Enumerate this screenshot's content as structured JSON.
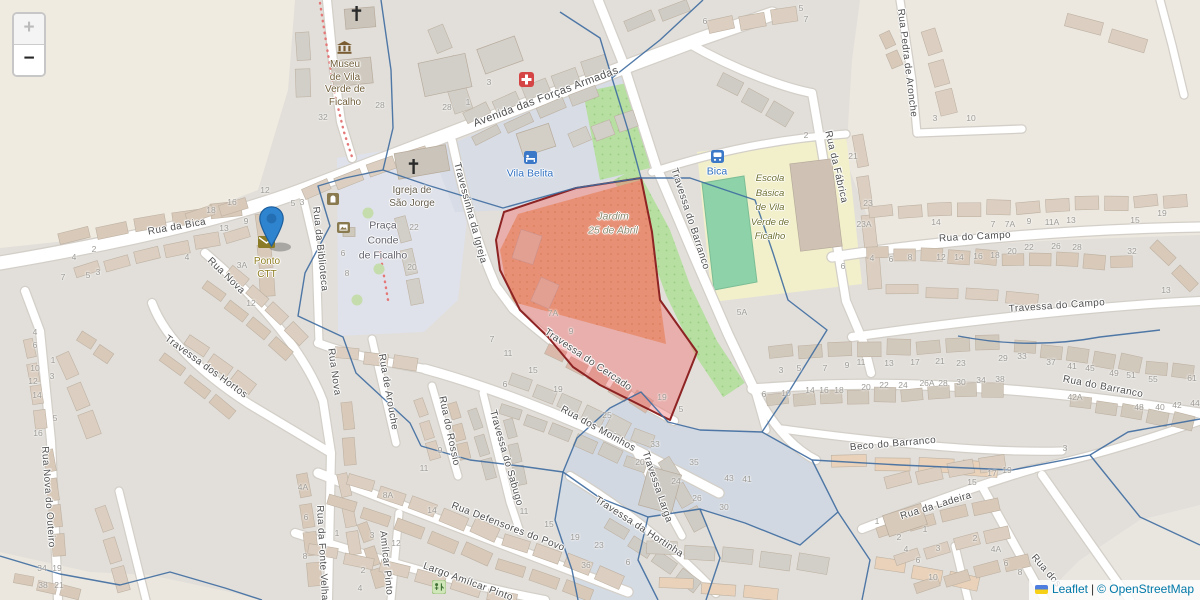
{
  "map": {
    "controls": {
      "zoom_in_label": "+",
      "zoom_out_label": "−"
    },
    "attribution": {
      "flag_icon": "ukraine-flag",
      "leaflet_link": "Leaflet",
      "separator": "|",
      "osm_link": "© OpenStreetMap"
    },
    "selected_area": {
      "name": "Jardim 25 de Abril area",
      "fill_color": "rgba(240,110,110,0.42)",
      "border_color": "#8d2323"
    },
    "marker": {
      "color": "#2e84cf"
    },
    "streets": [
      {
        "label": "Avenida das Forças Armadas",
        "x": 546,
        "y": 97,
        "rot": -20.5,
        "size": 11
      },
      {
        "label": "Rua da Bica",
        "x": 177,
        "y": 227,
        "rot": -10
      },
      {
        "label": "Rua Nova",
        "x": 226,
        "y": 276,
        "rot": 44
      },
      {
        "label": "Rua Nova",
        "x": 334,
        "y": 372,
        "rot": 82
      },
      {
        "label": "Rua Nova do Outeiro",
        "x": 48,
        "y": 497,
        "rot": 86
      },
      {
        "label": "Travessa dos Hortos",
        "x": 206,
        "y": 367,
        "rot": 36
      },
      {
        "label": "Rua da Biblioteca",
        "x": 320,
        "y": 249,
        "rot": 84
      },
      {
        "label": "Rua da Fonte Velha",
        "x": 322,
        "y": 553,
        "rot": 87
      },
      {
        "label": "Amílcar Pinto",
        "x": 386,
        "y": 563,
        "rot": 84
      },
      {
        "label": "Rua de Arouche",
        "x": 388,
        "y": 392,
        "rot": 80
      },
      {
        "label": "Rua do Rossio",
        "x": 449,
        "y": 431,
        "rot": 78
      },
      {
        "label": "Travessa do Sabugo",
        "x": 506,
        "y": 458,
        "rot": 74
      },
      {
        "label": "Rua dos Moinhos",
        "x": 598,
        "y": 429,
        "rot": 29
      },
      {
        "label": "Travessa Larga",
        "x": 657,
        "y": 487,
        "rot": 71
      },
      {
        "label": "Travessa da Hortinha",
        "x": 639,
        "y": 527,
        "rot": 33
      },
      {
        "label": "Rua Defensores do Povo",
        "x": 508,
        "y": 527,
        "rot": 21
      },
      {
        "label": "Largo Amílcar Pinto",
        "x": 468,
        "y": 582,
        "rot": 20
      },
      {
        "label": "Travessinha da Igreja",
        "x": 470,
        "y": 213,
        "rot": 75
      },
      {
        "label": "Travessa do Cercado",
        "x": 588,
        "y": 360,
        "rot": 34
      },
      {
        "label": "Travessa do Barranco",
        "x": 690,
        "y": 219,
        "rot": 72
      },
      {
        "label": "Rua da Fábrica",
        "x": 836,
        "y": 167,
        "rot": 77
      },
      {
        "label": "Rua Pedra de Aronche",
        "x": 907,
        "y": 63,
        "rot": 83
      },
      {
        "label": "Rua do Campo",
        "x": 975,
        "y": 237,
        "rot": -3
      },
      {
        "label": "Travessa do Campo",
        "x": 1057,
        "y": 306,
        "rot": -4
      },
      {
        "label": "Rua do Barranco",
        "x": 1103,
        "y": 387,
        "rot": 11
      },
      {
        "label": "Beco do Barranco",
        "x": 893,
        "y": 444,
        "rot": -5
      },
      {
        "label": "Rua da Ladeira",
        "x": 936,
        "y": 506,
        "rot": -17
      },
      {
        "label": "Rua dos",
        "x": 1046,
        "y": 571,
        "rot": 49
      }
    ],
    "pois": [
      {
        "name": "museum-label",
        "label": "Museu\nde Vila\nVerde de\nFicalho",
        "x": 345,
        "y": 84,
        "color": "#6f5d39",
        "size": 10,
        "lh": 12.5,
        "italic": false
      },
      {
        "name": "church-label",
        "label": "Igreja de\nSão Jorge",
        "x": 412,
        "y": 197,
        "color": "#655d4e",
        "size": 10,
        "lh": 13,
        "italic": false
      },
      {
        "name": "hotel-label",
        "label": "Vila Belita",
        "x": 530,
        "y": 174,
        "color": "#2f6fc0",
        "size": 10.5,
        "lh": 13,
        "italic": false
      },
      {
        "name": "square-label",
        "label": "Praça\nConde\nde Ficalho",
        "x": 383,
        "y": 241,
        "color": "#60606b",
        "size": 10.5,
        "lh": 15,
        "italic": false
      },
      {
        "name": "post-office-label",
        "label": "Ponto\nCTT",
        "x": 267,
        "y": 268,
        "color": "#8d7d1f",
        "size": 10,
        "lh": 13,
        "italic": false
      },
      {
        "name": "garden-label",
        "label": "Jardim\n25 de Abril",
        "x": 613,
        "y": 224,
        "color": "#8b8b72",
        "size": 10.5,
        "lh": 13.5,
        "italic": true
      },
      {
        "name": "school-label",
        "label": "Escola\nBásica\nde Vila\nVerde de\nFicalho",
        "x": 770,
        "y": 208,
        "color": "#6f7030",
        "size": 9.5,
        "lh": 14.5,
        "italic": true
      },
      {
        "name": "bus-stop-label",
        "label": "Bica",
        "x": 717,
        "y": 172,
        "color": "#2f6fc0",
        "size": 10.5,
        "lh": 13,
        "italic": false
      }
    ],
    "icons": [
      {
        "type": "church-icon",
        "x": 350,
        "y": 6
      },
      {
        "type": "museum-icon",
        "x": 337,
        "y": 41
      },
      {
        "type": "church-icon",
        "x": 407,
        "y": 159
      },
      {
        "type": "hotel-icon",
        "x": 524,
        "y": 151
      },
      {
        "type": "firstaid-icon",
        "x": 519,
        "y": 72
      },
      {
        "type": "mail-icon",
        "x": 258,
        "y": 236
      },
      {
        "type": "bus-icon",
        "x": 711,
        "y": 150
      },
      {
        "type": "monument-icon",
        "x": 327,
        "y": 193
      },
      {
        "type": "artwork-icon",
        "x": 337,
        "y": 222
      },
      {
        "type": "playground-icon",
        "x": 432,
        "y": 580
      }
    ],
    "house_numbers": [
      {
        "t": "28",
        "x": 380,
        "y": 105
      },
      {
        "t": "28",
        "x": 447,
        "y": 107
      },
      {
        "t": "1",
        "x": 468,
        "y": 102
      },
      {
        "t": "3",
        "x": 489,
        "y": 82
      },
      {
        "t": "32",
        "x": 323,
        "y": 117
      },
      {
        "t": "6",
        "x": 705,
        "y": 21
      },
      {
        "t": "5",
        "x": 801,
        "y": 8
      },
      {
        "t": "7",
        "x": 806,
        "y": 19
      },
      {
        "t": "2",
        "x": 806,
        "y": 135
      },
      {
        "t": "3",
        "x": 935,
        "y": 118
      },
      {
        "t": "10",
        "x": 971,
        "y": 118
      },
      {
        "t": "21",
        "x": 853,
        "y": 156
      },
      {
        "t": "5A",
        "x": 742,
        "y": 312
      },
      {
        "t": "23",
        "x": 868,
        "y": 203
      },
      {
        "t": "23A",
        "x": 864,
        "y": 224
      },
      {
        "t": "14",
        "x": 936,
        "y": 222
      },
      {
        "t": "7",
        "x": 993,
        "y": 224
      },
      {
        "t": "7A",
        "x": 1010,
        "y": 224
      },
      {
        "t": "9",
        "x": 1029,
        "y": 221
      },
      {
        "t": "11A",
        "x": 1052,
        "y": 222
      },
      {
        "t": "13",
        "x": 1071,
        "y": 220
      },
      {
        "t": "15",
        "x": 1135,
        "y": 220
      },
      {
        "t": "19",
        "x": 1162,
        "y": 213
      },
      {
        "t": "4",
        "x": 872,
        "y": 258
      },
      {
        "t": "6",
        "x": 891,
        "y": 259
      },
      {
        "t": "8",
        "x": 910,
        "y": 257
      },
      {
        "t": "12",
        "x": 941,
        "y": 257
      },
      {
        "t": "14",
        "x": 959,
        "y": 257
      },
      {
        "t": "16",
        "x": 978,
        "y": 256
      },
      {
        "t": "18",
        "x": 995,
        "y": 255
      },
      {
        "t": "20",
        "x": 1012,
        "y": 251
      },
      {
        "t": "22",
        "x": 1029,
        "y": 247
      },
      {
        "t": "26",
        "x": 1056,
        "y": 246
      },
      {
        "t": "28",
        "x": 1077,
        "y": 247
      },
      {
        "t": "32",
        "x": 1132,
        "y": 251
      },
      {
        "t": "6",
        "x": 843,
        "y": 266
      },
      {
        "t": "13",
        "x": 1166,
        "y": 290
      },
      {
        "t": "3",
        "x": 781,
        "y": 370
      },
      {
        "t": "5",
        "x": 799,
        "y": 368
      },
      {
        "t": "7",
        "x": 825,
        "y": 368
      },
      {
        "t": "9",
        "x": 847,
        "y": 365
      },
      {
        "t": "11",
        "x": 861,
        "y": 362
      },
      {
        "t": "13",
        "x": 889,
        "y": 363
      },
      {
        "t": "17",
        "x": 915,
        "y": 362
      },
      {
        "t": "21",
        "x": 940,
        "y": 361
      },
      {
        "t": "23",
        "x": 961,
        "y": 363
      },
      {
        "t": "29",
        "x": 1003,
        "y": 358
      },
      {
        "t": "33",
        "x": 1022,
        "y": 356
      },
      {
        "t": "37",
        "x": 1051,
        "y": 362
      },
      {
        "t": "41",
        "x": 1072,
        "y": 366
      },
      {
        "t": "45",
        "x": 1090,
        "y": 368
      },
      {
        "t": "49",
        "x": 1114,
        "y": 373
      },
      {
        "t": "51",
        "x": 1131,
        "y": 375
      },
      {
        "t": "55",
        "x": 1153,
        "y": 379
      },
      {
        "t": "61",
        "x": 1192,
        "y": 378
      },
      {
        "t": "6",
        "x": 764,
        "y": 394
      },
      {
        "t": "10",
        "x": 786,
        "y": 393
      },
      {
        "t": "14",
        "x": 810,
        "y": 390
      },
      {
        "t": "16",
        "x": 824,
        "y": 390
      },
      {
        "t": "18",
        "x": 839,
        "y": 390
      },
      {
        "t": "20",
        "x": 866,
        "y": 387
      },
      {
        "t": "22",
        "x": 884,
        "y": 385
      },
      {
        "t": "24",
        "x": 903,
        "y": 385
      },
      {
        "t": "26A",
        "x": 927,
        "y": 383
      },
      {
        "t": "28",
        "x": 943,
        "y": 383
      },
      {
        "t": "30",
        "x": 961,
        "y": 382
      },
      {
        "t": "34",
        "x": 981,
        "y": 380
      },
      {
        "t": "38",
        "x": 1000,
        "y": 379
      },
      {
        "t": "42A",
        "x": 1075,
        "y": 397
      },
      {
        "t": "48",
        "x": 1139,
        "y": 407
      },
      {
        "t": "40",
        "x": 1160,
        "y": 407
      },
      {
        "t": "42",
        "x": 1177,
        "y": 405
      },
      {
        "t": "44",
        "x": 1195,
        "y": 403
      },
      {
        "t": "3",
        "x": 1065,
        "y": 448
      },
      {
        "t": "15",
        "x": 972,
        "y": 482
      },
      {
        "t": "17",
        "x": 992,
        "y": 473
      },
      {
        "t": "19",
        "x": 1007,
        "y": 470
      },
      {
        "t": "1",
        "x": 877,
        "y": 521
      },
      {
        "t": "2",
        "x": 899,
        "y": 537
      },
      {
        "t": "4",
        "x": 906,
        "y": 549
      },
      {
        "t": "6",
        "x": 918,
        "y": 560
      },
      {
        "t": "10",
        "x": 933,
        "y": 577
      },
      {
        "t": "1",
        "x": 925,
        "y": 529
      },
      {
        "t": "3",
        "x": 938,
        "y": 548
      },
      {
        "t": "2",
        "x": 975,
        "y": 538
      },
      {
        "t": "4A",
        "x": 996,
        "y": 549
      },
      {
        "t": "6",
        "x": 1006,
        "y": 563
      },
      {
        "t": "8",
        "x": 1020,
        "y": 572
      },
      {
        "t": "33",
        "x": 655,
        "y": 444
      },
      {
        "t": "20",
        "x": 640,
        "y": 462
      },
      {
        "t": "35",
        "x": 694,
        "y": 462
      },
      {
        "t": "24",
        "x": 676,
        "y": 481
      },
      {
        "t": "26",
        "x": 697,
        "y": 498
      },
      {
        "t": "30",
        "x": 724,
        "y": 507
      },
      {
        "t": "43",
        "x": 729,
        "y": 478
      },
      {
        "t": "41",
        "x": 747,
        "y": 479
      },
      {
        "t": "6",
        "x": 628,
        "y": 562
      },
      {
        "t": "23",
        "x": 599,
        "y": 545
      },
      {
        "t": "36",
        "x": 586,
        "y": 565
      },
      {
        "t": "19",
        "x": 575,
        "y": 537
      },
      {
        "t": "15",
        "x": 549,
        "y": 524
      },
      {
        "t": "11",
        "x": 524,
        "y": 511
      },
      {
        "t": "9",
        "x": 440,
        "y": 450
      },
      {
        "t": "11",
        "x": 424,
        "y": 468
      },
      {
        "t": "14",
        "x": 432,
        "y": 510
      },
      {
        "t": "8A",
        "x": 388,
        "y": 495
      },
      {
        "t": "4A",
        "x": 303,
        "y": 487
      },
      {
        "t": "6",
        "x": 306,
        "y": 517
      },
      {
        "t": "8",
        "x": 305,
        "y": 556
      },
      {
        "t": "1",
        "x": 337,
        "y": 533
      },
      {
        "t": "3",
        "x": 372,
        "y": 535
      },
      {
        "t": "12",
        "x": 396,
        "y": 543
      },
      {
        "t": "2",
        "x": 363,
        "y": 570
      },
      {
        "t": "4",
        "x": 360,
        "y": 588
      },
      {
        "t": "7A",
        "x": 553,
        "y": 313
      },
      {
        "t": "9",
        "x": 571,
        "y": 331
      },
      {
        "t": "7",
        "x": 492,
        "y": 339
      },
      {
        "t": "11",
        "x": 508,
        "y": 353
      },
      {
        "t": "15",
        "x": 533,
        "y": 370
      },
      {
        "t": "6",
        "x": 505,
        "y": 384
      },
      {
        "t": "19",
        "x": 558,
        "y": 389
      },
      {
        "t": "25",
        "x": 607,
        "y": 415
      },
      {
        "t": "19",
        "x": 662,
        "y": 397
      },
      {
        "t": "5",
        "x": 681,
        "y": 409
      },
      {
        "t": "4",
        "x": 35,
        "y": 332
      },
      {
        "t": "6",
        "x": 35,
        "y": 345
      },
      {
        "t": "10",
        "x": 35,
        "y": 368
      },
      {
        "t": "12",
        "x": 33,
        "y": 381
      },
      {
        "t": "14",
        "x": 37,
        "y": 395
      },
      {
        "t": "16",
        "x": 38,
        "y": 433
      },
      {
        "t": "1",
        "x": 53,
        "y": 360
      },
      {
        "t": "3",
        "x": 52,
        "y": 376
      },
      {
        "t": "5",
        "x": 55,
        "y": 418
      },
      {
        "t": "34",
        "x": 42,
        "y": 568
      },
      {
        "t": "19",
        "x": 57,
        "y": 568
      },
      {
        "t": "38",
        "x": 43,
        "y": 585
      },
      {
        "t": "21",
        "x": 59,
        "y": 585
      },
      {
        "t": "18",
        "x": 211,
        "y": 210
      },
      {
        "t": "16",
        "x": 232,
        "y": 202
      },
      {
        "t": "13",
        "x": 224,
        "y": 228
      },
      {
        "t": "9",
        "x": 246,
        "y": 221
      },
      {
        "t": "4",
        "x": 74,
        "y": 257
      },
      {
        "t": "2",
        "x": 94,
        "y": 249
      },
      {
        "t": "7",
        "x": 63,
        "y": 277
      },
      {
        "t": "5",
        "x": 88,
        "y": 275
      },
      {
        "t": "3",
        "x": 98,
        "y": 272
      },
      {
        "t": "4",
        "x": 187,
        "y": 257
      },
      {
        "t": "3A",
        "x": 242,
        "y": 265
      },
      {
        "t": "12",
        "x": 251,
        "y": 303
      },
      {
        "t": "5",
        "x": 293,
        "y": 203
      },
      {
        "t": "3",
        "x": 302,
        "y": 202
      },
      {
        "t": "12",
        "x": 265,
        "y": 190
      },
      {
        "t": "22",
        "x": 414,
        "y": 227
      },
      {
        "t": "20",
        "x": 412,
        "y": 267
      },
      {
        "t": "6",
        "x": 343,
        "y": 253
      },
      {
        "t": "8",
        "x": 347,
        "y": 273
      }
    ]
  }
}
